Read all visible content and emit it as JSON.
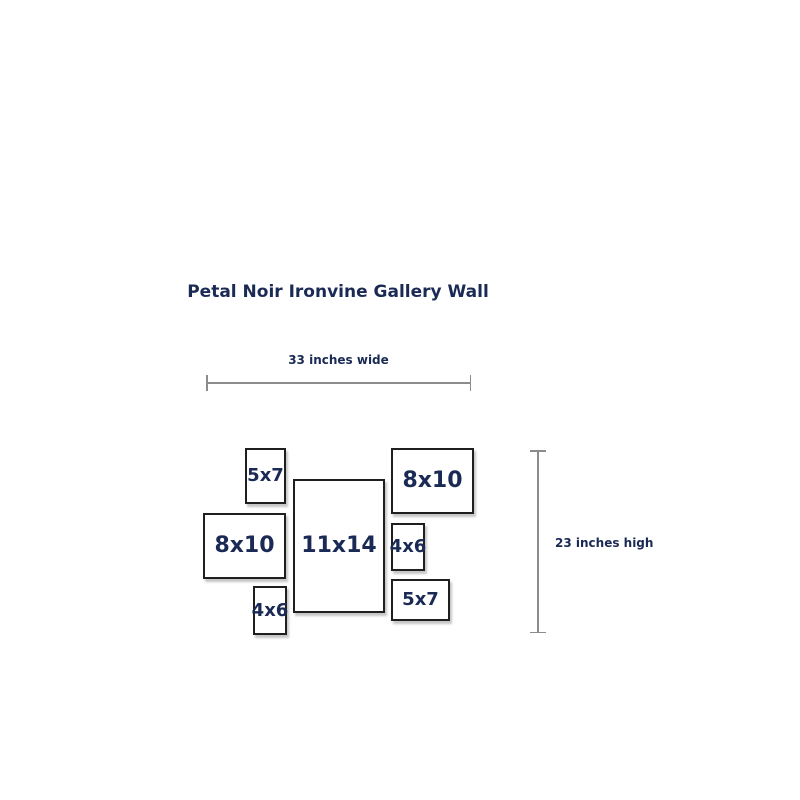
{
  "title": "Petal Noir Ironvine Gallery Wall",
  "dimensions": {
    "width_label": "33 inches wide",
    "height_label": "23 inches high",
    "width_inches": 33,
    "height_inches": 23
  },
  "frames": [
    {
      "label": "5x7",
      "orientation": "portrait",
      "x": 245,
      "y": 448,
      "w": 41,
      "h": 56,
      "labelSize": 18
    },
    {
      "label": "8x10",
      "orientation": "landscape",
      "x": 391,
      "y": 448,
      "w": 83,
      "h": 66,
      "labelSize": 22
    },
    {
      "label": "11x14",
      "orientation": "portrait",
      "x": 293,
      "y": 479,
      "w": 92,
      "h": 134,
      "labelSize": 22
    },
    {
      "label": "8x10",
      "orientation": "landscape",
      "x": 203,
      "y": 513,
      "w": 83,
      "h": 66,
      "labelSize": 22
    },
    {
      "label": "4x6",
      "orientation": "portrait",
      "x": 391,
      "y": 523,
      "w": 34,
      "h": 48,
      "labelSize": 18
    },
    {
      "label": "5x7",
      "orientation": "landscape",
      "x": 391,
      "y": 579,
      "w": 59,
      "h": 42,
      "labelSize": 18
    },
    {
      "label": "4x6",
      "orientation": "portrait",
      "x": 253,
      "y": 586,
      "w": 34,
      "h": 49,
      "labelSize": 18
    }
  ],
  "colors": {
    "text": "#1a2a55",
    "frame_border": "#1f1f1f",
    "dimension_line": "#8c8c8c",
    "background": "#ffffff"
  }
}
